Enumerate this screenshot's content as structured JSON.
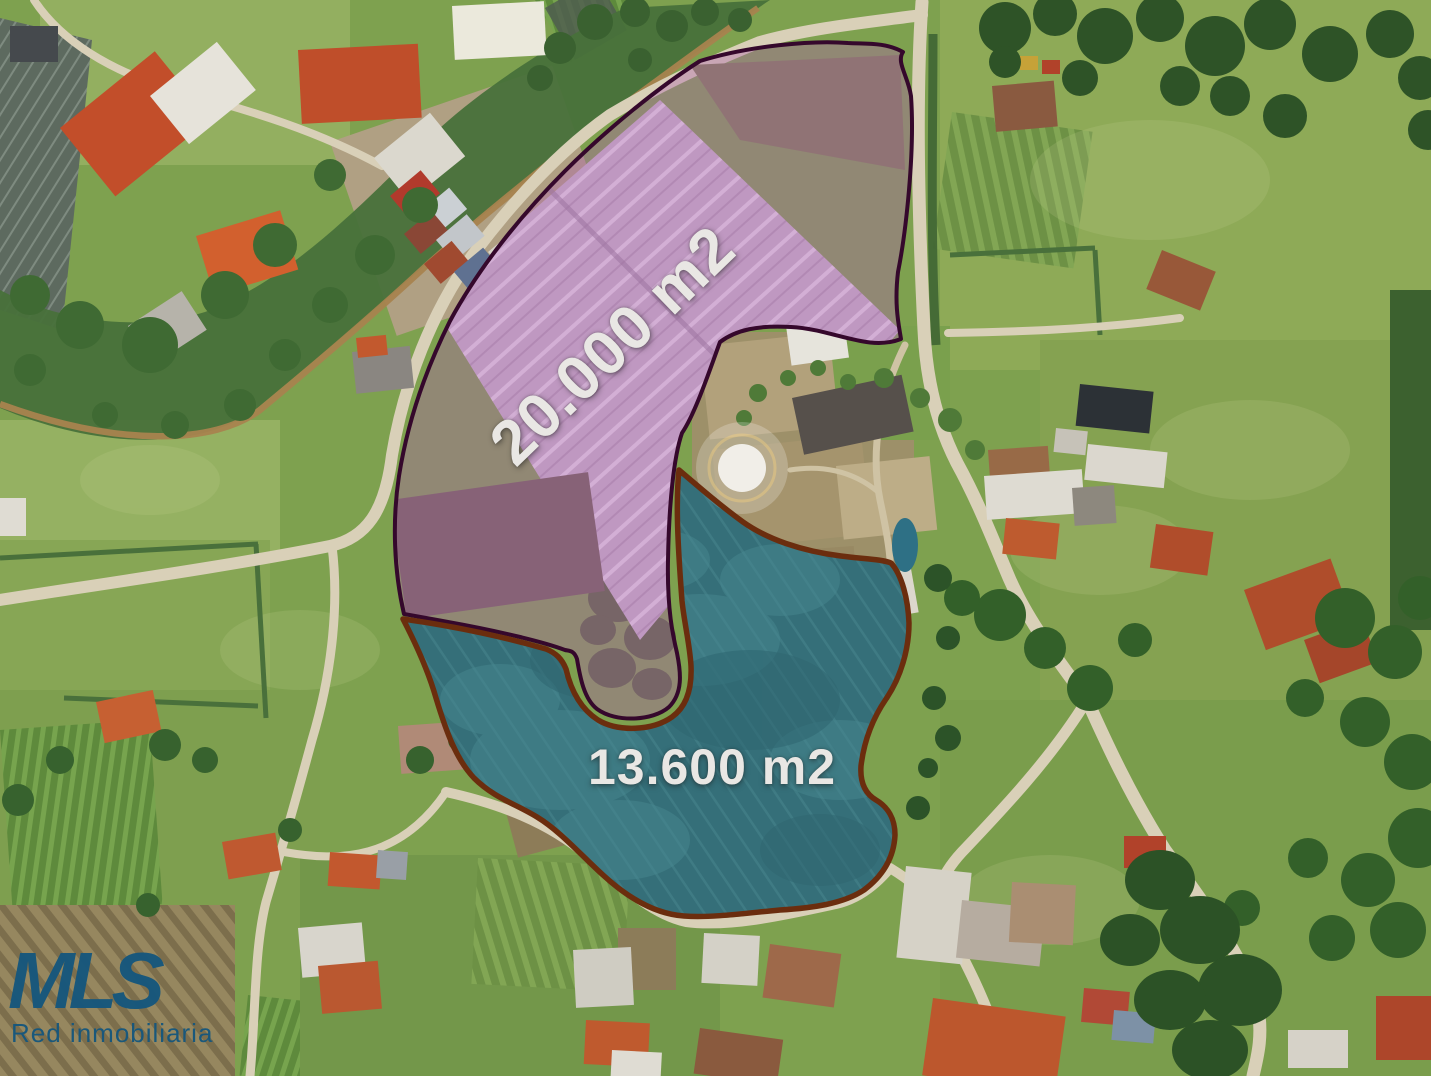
{
  "scene": {
    "type": "aerial-drone-photograph",
    "description": "Rural real-estate aerial photo with two outlined parcels over greenhouses and shade-net crop fields, surrounded by pastures, houses, roads and a stream"
  },
  "annotations": {
    "parcels": [
      {
        "name": "greenhouse-parcel",
        "area_label": "20.000 m2",
        "fill_color": "#b062b0",
        "border_color": "#35082c",
        "label_rotation_deg": -44
      },
      {
        "name": "shade-net-crops-parcel",
        "area_label": "13.600 m2",
        "fill_color": "#3f93b5",
        "border_color": "#6b2d0e",
        "label_rotation_deg": 0
      }
    ],
    "label_text_color": "#e9e7e4"
  },
  "logo": {
    "title": "MLS",
    "subtitle": "Red inmobiliaria",
    "color": "#15577d"
  }
}
